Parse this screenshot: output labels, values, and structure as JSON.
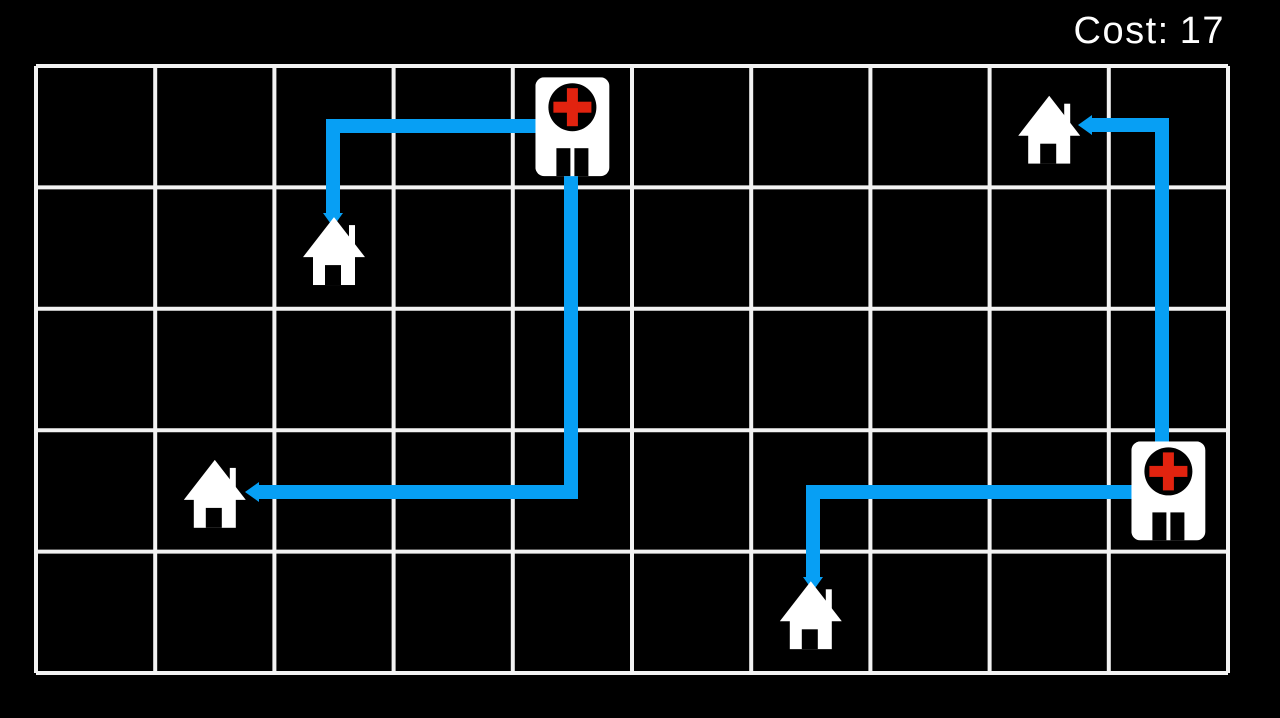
{
  "hud": {
    "cost_label": "Cost:",
    "cost_value": "17"
  },
  "game": {
    "cost": 17,
    "grid": {
      "cols": 10,
      "rows": 5,
      "x": 36,
      "y": 66,
      "cell_w": 119.2,
      "cell_h": 121.4,
      "line_width": 4
    },
    "buildings": [
      {
        "id": "hospital-1",
        "type": "hospital",
        "col": 4,
        "row": 0
      },
      {
        "id": "hospital-2",
        "type": "hospital",
        "col": 9,
        "row": 3
      },
      {
        "id": "house-1",
        "type": "house",
        "col": 2,
        "row": 1
      },
      {
        "id": "house-2",
        "type": "house",
        "col": 1,
        "row": 3
      },
      {
        "id": "house-3",
        "type": "house",
        "col": 8,
        "row": 0
      },
      {
        "id": "house-4",
        "type": "house",
        "col": 6,
        "row": 4
      }
    ],
    "routes": [
      {
        "id": "route-1",
        "from": "hospital-1",
        "to": "house-1",
        "points": [
          [
            545,
            126
          ],
          [
            333,
            126
          ],
          [
            333,
            213
          ]
        ],
        "arrow_tip": [
          333,
          227
        ]
      },
      {
        "id": "route-2",
        "from": "hospital-1",
        "to": "house-2",
        "points": [
          [
            571,
            170
          ],
          [
            571,
            492
          ],
          [
            259,
            492
          ]
        ],
        "arrow_tip": [
          245,
          492
        ]
      },
      {
        "id": "route-3",
        "from": "hospital-2",
        "to": "house-3",
        "points": [
          [
            1162,
            452
          ],
          [
            1162,
            125
          ],
          [
            1092,
            125
          ]
        ],
        "arrow_tip": [
          1078,
          125
        ]
      },
      {
        "id": "route-4",
        "from": "hospital-2",
        "to": "house-4",
        "points": [
          [
            1140,
            492
          ],
          [
            813,
            492
          ],
          [
            813,
            577
          ]
        ],
        "arrow_tip": [
          813,
          591
        ]
      }
    ]
  },
  "colors": {
    "background": "#000000",
    "grid_line": "#f2f2f2",
    "route": "#079ff4",
    "building_fill": "#ffffff",
    "hospital_circle": "#000000",
    "hospital_cross": "#e2230f",
    "door": "#000000",
    "hud_text": "#ffffff"
  }
}
